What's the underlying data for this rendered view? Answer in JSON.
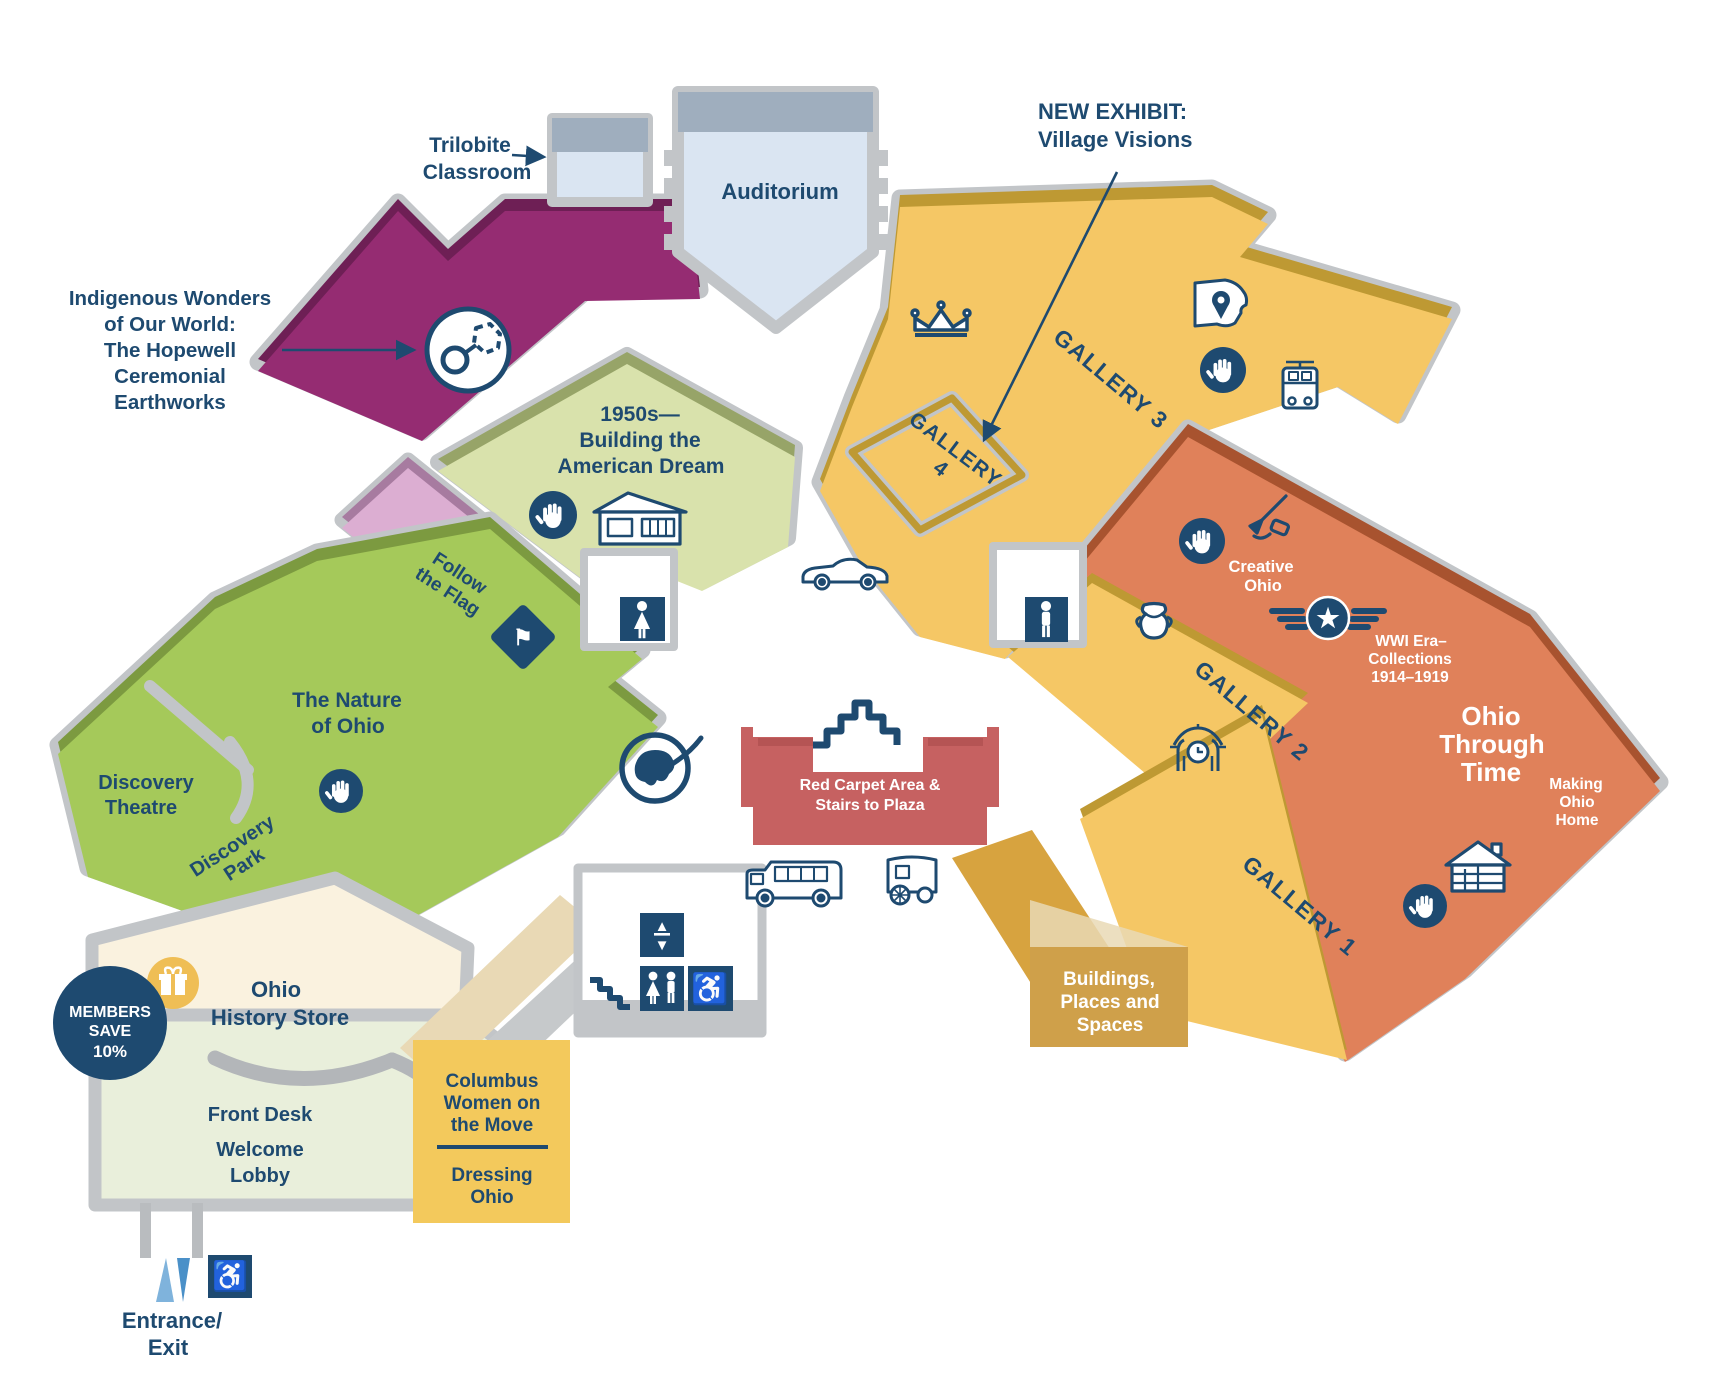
{
  "page": {
    "width": 1721,
    "height": 1398,
    "background": "#FFFFFF"
  },
  "colors": {
    "navy": "#1E4A70",
    "purple": "#952C72",
    "purple_wall": "#6E1F55",
    "light_green": "#D9E2AC",
    "light_green_wall": "#97A468",
    "pink": "#DCAED2",
    "pink_wall": "#A77BA0",
    "green": "#A5C95A",
    "green_wall": "#7C9A40",
    "yellow": "#F5C765",
    "yellow_wall": "#BE9933",
    "orange": "#E0815A",
    "orange_wall": "#A8532F",
    "light_blue": "#DAE5F2",
    "slate_band": "#9FAEBE",
    "wall_gray": "#C2C5C8",
    "red_carpet": "#C66161",
    "gold_box": "#F3C95C",
    "gold_dark_box": "#CFA04A",
    "ramp_gold": "#D7A33F",
    "cream": "#FAF2DF",
    "lobby_green": "#E9EFDB",
    "tan_walk": "#E9D9B5",
    "entrance_blue": "#2B8FCB",
    "arrow_light_blue": "#7FB3DC",
    "arrow_dark_blue": "#4A90C8",
    "gift_gold": "#EFBE55"
  },
  "rooms": {
    "trilobite": {
      "lines": [
        "Trilobite",
        "Classroom"
      ]
    },
    "auditorium": {
      "text": "Auditorium"
    },
    "new_exhibit": {
      "lines": [
        "NEW EXHIBIT:",
        "Village Visions"
      ]
    },
    "indigenous": {
      "lines": [
        "Indigenous Wonders",
        "of Our World:",
        "The Hopewell",
        "Ceremonial",
        "Earthworks"
      ]
    },
    "fifties": {
      "lines": [
        "1950s—",
        "Building the",
        "American Dream"
      ]
    },
    "follow_flag": {
      "lines": [
        "Follow",
        "the Flag"
      ]
    },
    "nature": {
      "lines": [
        "The Nature",
        "of Ohio"
      ]
    },
    "discovery_theatre": {
      "lines": [
        "Discovery",
        "Theatre"
      ]
    },
    "discovery_park": {
      "lines": [
        "Discovery",
        "Park"
      ]
    },
    "gallery3": {
      "text": "GALLERY 3"
    },
    "gallery4": {
      "lines": [
        "GALLERY",
        "4"
      ]
    },
    "gallery2": {
      "text": "GALLERY 2"
    },
    "gallery1": {
      "text": "GALLERY 1"
    },
    "creative_ohio": {
      "lines": [
        "Creative",
        "Ohio"
      ]
    },
    "wwi": {
      "lines": [
        "WWI Era–",
        "Collections",
        "1914–1919"
      ]
    },
    "ohio_through_time": {
      "lines": [
        "Ohio",
        "Through",
        "Time"
      ]
    },
    "making_ohio_home": {
      "lines": [
        "Making",
        "Ohio",
        "Home"
      ]
    },
    "red_carpet": {
      "lines": [
        "Red Carpet Area &",
        "Stairs to Plaza"
      ]
    },
    "buildings": {
      "lines": [
        "Buildings,",
        "Places and",
        "Spaces"
      ]
    },
    "store": {
      "lines": [
        "Ohio",
        "History Store"
      ]
    },
    "members": {
      "lines": [
        "MEMBERS",
        "SAVE",
        "10%"
      ]
    },
    "front_desk": {
      "text": "Front Desk"
    },
    "welcome_lobby": {
      "lines": [
        "Welcome",
        "Lobby"
      ]
    },
    "columbus_women": {
      "lines": [
        "Columbus",
        "Women on",
        "the Move"
      ]
    },
    "dressing_ohio": {
      "lines": [
        "Dressing",
        "Ohio"
      ]
    },
    "entrance": {
      "lines": [
        "Entrance/",
        "Exit"
      ]
    }
  },
  "icons": {
    "wheelchair_glyph": "♿",
    "star_glyph": "★",
    "flag_glyph": "⚑",
    "elevator_up": "▲",
    "elevator_down": "▼"
  }
}
